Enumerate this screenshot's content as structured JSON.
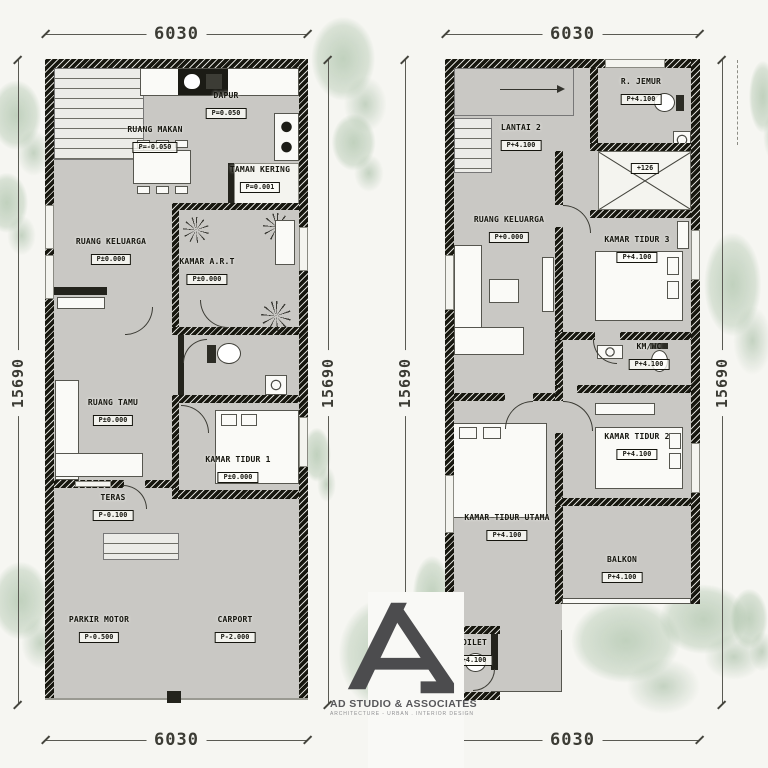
{
  "brand": {
    "name": "AD STUDIO & ASSOCIATES",
    "tagline": "ARCHITECTURE - URBAN . INTERIOR DESIGN"
  },
  "dimensions": {
    "width": "6030",
    "depth": "15690"
  },
  "floor1": {
    "rooms": [
      {
        "label": "DAPUR",
        "level": "P=0.050"
      },
      {
        "label": "RUANG MAKAN",
        "level": "P=-0.050"
      },
      {
        "label": "TAMAN KERING",
        "level": "P=0.001"
      },
      {
        "label": "RUANG KELUARGA",
        "level": "P±0.000"
      },
      {
        "label": "KAMAR A.R.T",
        "level": "P±0.000"
      },
      {
        "label": "RUANG TAMU",
        "level": "P±0.000"
      },
      {
        "label": "KAMAR TIDUR 1",
        "level": "P±0.000"
      },
      {
        "label": "TERAS",
        "level": "P-0.100"
      },
      {
        "label": "PARKIR MOTOR",
        "level": "P-0.500"
      },
      {
        "label": "CARPORT",
        "level": "P-2.000"
      }
    ]
  },
  "floor2": {
    "rooms": [
      {
        "label": "LANTAI 2",
        "level": "P+4.100"
      },
      {
        "label": "R. JEMUR",
        "level": "P+4.100"
      },
      {
        "label": "",
        "level": "+126"
      },
      {
        "label": "RUANG KELUARGA",
        "level": "P+0.000"
      },
      {
        "label": "KAMAR TIDUR 3",
        "level": "P+4.100"
      },
      {
        "label": "KM/WC",
        "level": "P+4.100"
      },
      {
        "label": "KAMAR TIDUR 2",
        "level": "P+4.100"
      },
      {
        "label": "KAMAR TIDUR UTAMA",
        "level": "P+4.100"
      },
      {
        "label": "BALKON",
        "level": "P+4.100"
      },
      {
        "label": "TOILET",
        "level": "P+4.100"
      }
    ]
  }
}
